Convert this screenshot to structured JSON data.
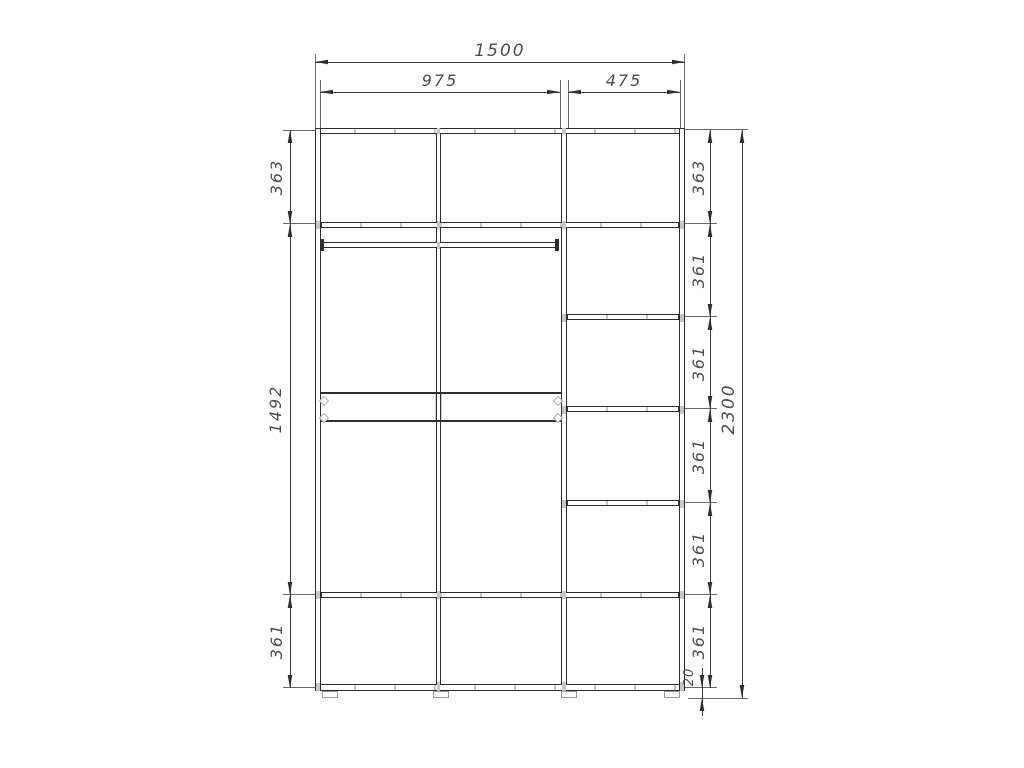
{
  "dimensions": {
    "top": {
      "total_width": "1500",
      "left_section_width": "975",
      "right_section_width": "475"
    },
    "left": {
      "upper": "363",
      "middle": "1492",
      "lower": "361"
    },
    "right_column": [
      "363",
      "361",
      "361",
      "361",
      "361",
      "361"
    ],
    "total_height": "2300",
    "base_height": "20"
  },
  "colors": {
    "line": "#2e2e2e",
    "dimension_line": "#3a3a3a",
    "text": "#4d4d4d",
    "hardware_marker": "#c6c6c6",
    "background": "#ffffff"
  }
}
